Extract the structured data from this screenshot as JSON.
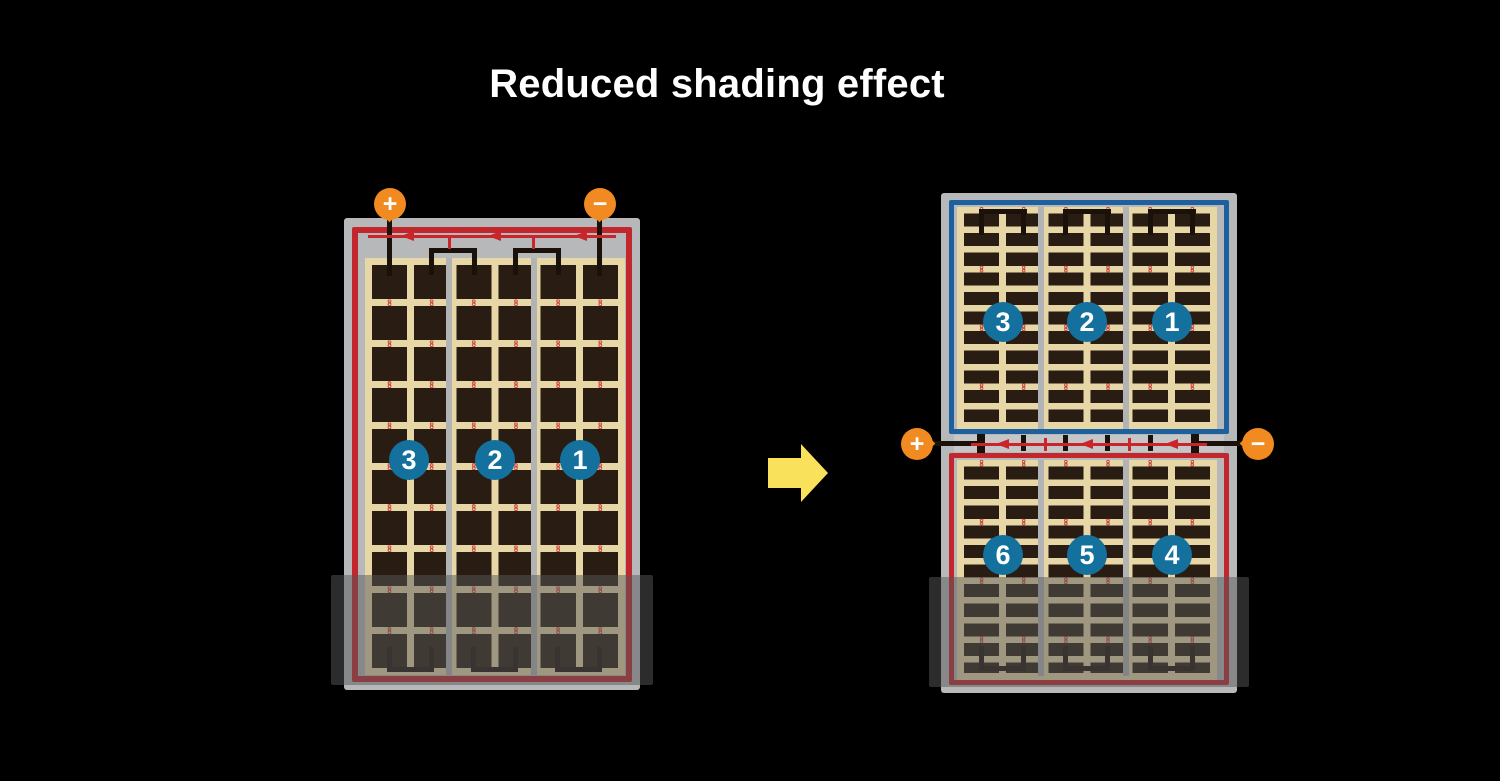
{
  "title": "Reduced shading effect",
  "colors": {
    "background": "#000000",
    "title_text": "#ffffff",
    "frame_gray": "#b7b8ba",
    "cell_tan": "#e7d6a6",
    "cell_dark": "#281c13",
    "divider_gray": "#b1b3b5",
    "series_red": "#c1272d",
    "diode_red": "#c9252b",
    "series_blue": "#1e5f9e",
    "circle_blue": "#14719e",
    "circle_text": "#ffffff",
    "terminal_orange": "#f08a21",
    "terminal_text": "#ffffff",
    "wire_black": "#1a110b",
    "dot_red": "#cf4a41",
    "dot_core": "#f2ead9",
    "shade_overlay": "rgba(88,88,88,0.5)",
    "arrow_yellow": "#f9e15b",
    "junction_gray": "#c5c6c8"
  },
  "left_panel": {
    "terminals": {
      "positive_label": "+",
      "negative_label": "−"
    },
    "section_labels": [
      "3",
      "2",
      "1"
    ]
  },
  "right_panel": {
    "terminals": {
      "positive_label": "+",
      "negative_label": "−"
    },
    "top_section_labels": [
      "3",
      "2",
      "1"
    ],
    "bottom_section_labels": [
      "6",
      "5",
      "4"
    ]
  }
}
